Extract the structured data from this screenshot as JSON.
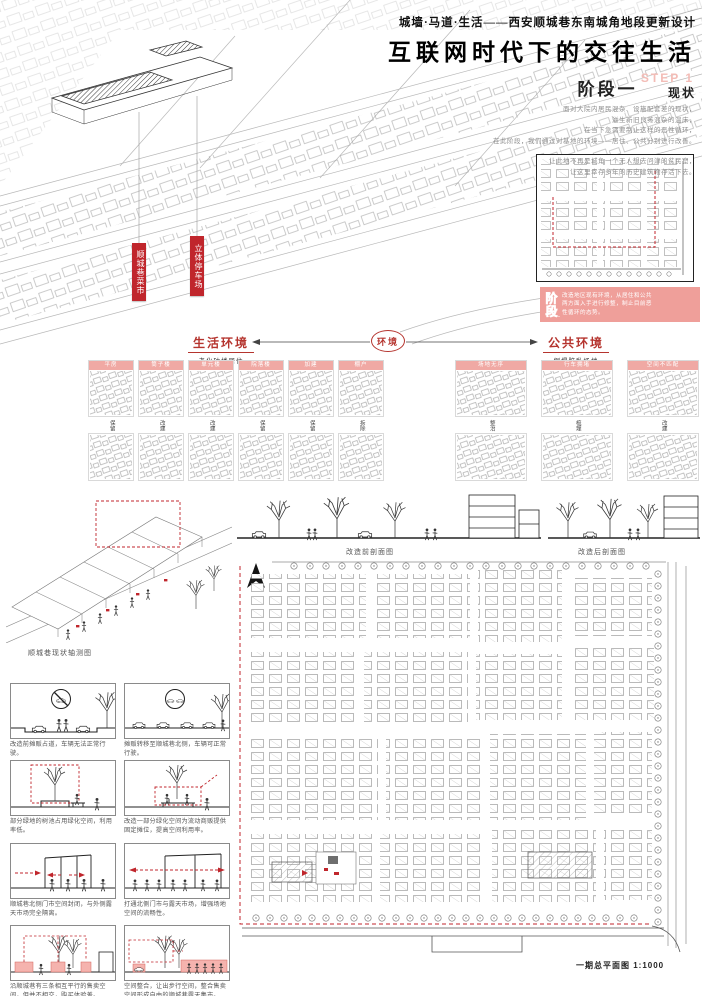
{
  "colors": {
    "accent_red": "#c0262c",
    "pink": "#ef9f9a",
    "pink_light": "#f3bcb6",
    "line_gray": "#9a9a9a"
  },
  "header": {
    "series_title": "城墙·马道·生活——西安顺城巷东南城角地段更新设计",
    "main_title": "互联网时代下的交往生活",
    "stage_label": "阶段一",
    "step_watermark": "STEP 1",
    "stage_status": "现状",
    "intro_lines": [
      "面对大院内居民混杂、设施配套差的现状，",
      "滋生新旧良莠混杂的温床，",
      "在当下急需要制止这样的恶性循环，",
      "在此阶段，我们通过对基地的环境——居住、公共分别进行改善。"
    ],
    "intro_lines_2": [
      "让此地不再是城角一个无人想去问津的贫民窟，",
      "让这里幸存多年的历史建筑物存活下去。"
    ]
  },
  "axon": {
    "label_market": "顺城巷菜市",
    "label_parking": "立体停车场",
    "caption": "顺城巷现状轴测图"
  },
  "inset": {
    "stage_vertical": "阶段",
    "stage_dash": "——",
    "desc_lines": [
      "改造地区现有环境，从居住和公共",
      "两方面入手进行修整，制止目前恶",
      "性循环的态势。"
    ]
  },
  "environment": {
    "center_label": "环境",
    "left_title": "生活环境",
    "left_subtitle": "老化破楼居住",
    "right_title": "公共环境",
    "right_subtitle": "倒塌脏乱场地",
    "left_grid": {
      "headers": [
        "平房",
        "筒子楼",
        "单元楼",
        "院落楼",
        "加建",
        "棚户"
      ],
      "row_labels": [
        "保留",
        "改建",
        "改建",
        "保留",
        "保留",
        "拆除"
      ]
    },
    "right_grid": {
      "headers": [
        "场地无序",
        "行车拥堵",
        "空间不匹配"
      ],
      "row_labels": [
        "整治",
        "梳理",
        "改建"
      ]
    }
  },
  "sections": {
    "before_caption": "改造前剖面图",
    "after_caption": "改造后剖面图"
  },
  "siteplan": {
    "caption": "一期总平面图 1:1000"
  },
  "panels": [
    {
      "caption": "改造前摊贩占道，车辆无法正常行驶。"
    },
    {
      "caption": "摊贩转移至顺城巷北侧，车辆可正常行驶。"
    },
    {
      "caption": "部分绿地的树池占用绿化空间，利用率低。"
    },
    {
      "caption": "改造一部分绿化空间为流动商贩提供固定摊位，提高空间利用率。"
    },
    {
      "caption": "顺城巷北侧门市空间封闭，与外侧露天市场完全隔离。"
    },
    {
      "caption": "打通北侧门市与露天市场，增强场地空间的流畅性。"
    },
    {
      "caption": "沿顺城巷有三条相互平行的售卖空间，但并不相交，购买体验差。"
    },
    {
      "caption": "空间整合，让出步行空间，整合售卖空间形成自由的顺城巷露天集市。"
    }
  ]
}
